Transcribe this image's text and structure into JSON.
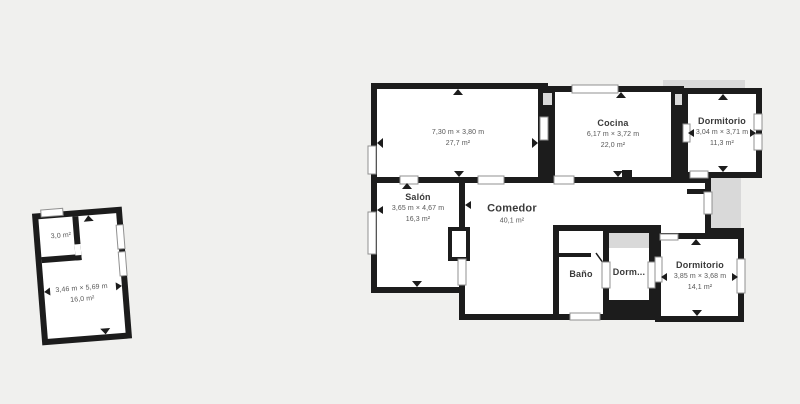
{
  "colors": {
    "background": "#f0f0ee",
    "wall": "#1c1c1c",
    "room_fill": "#ffffff",
    "terrace_fill": "#d9d9d9",
    "window_stroke": "#909090",
    "room_name_text": "#3a3a3a",
    "dims_text": "#565656"
  },
  "annex": {
    "storage": {
      "area": "3,0 m²"
    },
    "room": {
      "dims": "3,46 m × 5,69 m",
      "area": "16,0 m²"
    }
  },
  "rooms": {
    "living_large": {
      "dims": "7,30 m × 3,80 m",
      "area": "27,7 m²"
    },
    "cocina": {
      "name": "Cocina",
      "dims": "6,17 m × 3,72 m",
      "area": "22,0 m²"
    },
    "dormitorio_top": {
      "name": "Dormitorio",
      "dims": "3,04 m × 3,71 m",
      "area": "11,3 m²"
    },
    "salon": {
      "name": "Salón",
      "dims": "3,65 m × 4,67 m",
      "area": "16,3 m²"
    },
    "comedor": {
      "name": "Comedor",
      "area": "40,1 m²"
    },
    "bano": {
      "name": "Baño"
    },
    "dormitorio_mid": {
      "name": "Dorm..."
    },
    "dormitorio_right": {
      "name": "Dormitorio",
      "dims": "3,85 m × 3,68 m",
      "area": "14,1 m²"
    }
  }
}
